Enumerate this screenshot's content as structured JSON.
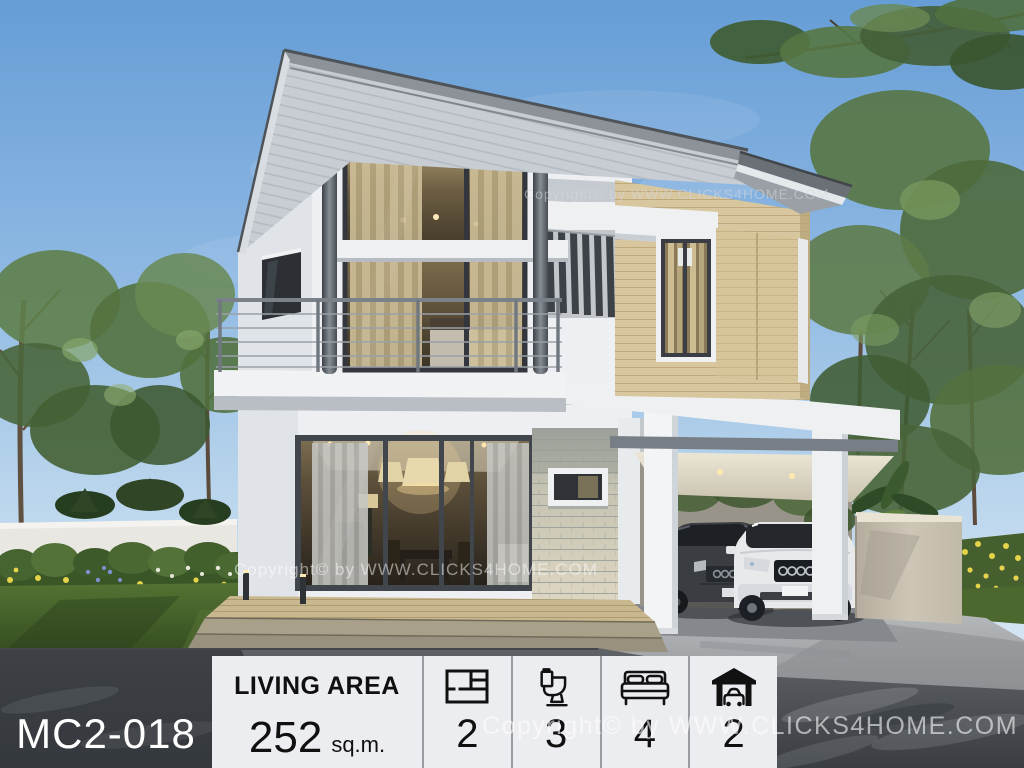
{
  "scene": {
    "description": "3D exterior rendering of a modern two-storey house with balcony, wood-panel upper wing, stone accent wall, carport with two cars, lawn, flowering hedge, trees and driveway",
    "sky_color": "#669dd6",
    "wall_color": "#edeff2",
    "roof_color": "#6a7076",
    "wood_color": "#d8c79e",
    "lawn_color": "#47632c",
    "road_color": "#4a4e52"
  },
  "watermarks": {
    "upper": "Copyright© by WWW.CLICKS4HOME.COM",
    "middle": "Copyright© by WWW.CLICKS4HOME.COM",
    "lower": "Copyright© by WWW.CLICKS4HOME.COM"
  },
  "info_bar": {
    "model_code": "MC2-018",
    "living_area": {
      "label": "LIVING AREA",
      "value": "252",
      "unit": "sq.m."
    },
    "stats": [
      {
        "icon": "floorplan-icon",
        "value": "2"
      },
      {
        "icon": "toilet-icon",
        "value": "3"
      },
      {
        "icon": "bed-icon",
        "value": "4"
      },
      {
        "icon": "garage-icon",
        "value": "2"
      }
    ],
    "panel_bg": "#ecedf1",
    "text_color": "#101010",
    "divider_color": "#9b9ba3"
  }
}
